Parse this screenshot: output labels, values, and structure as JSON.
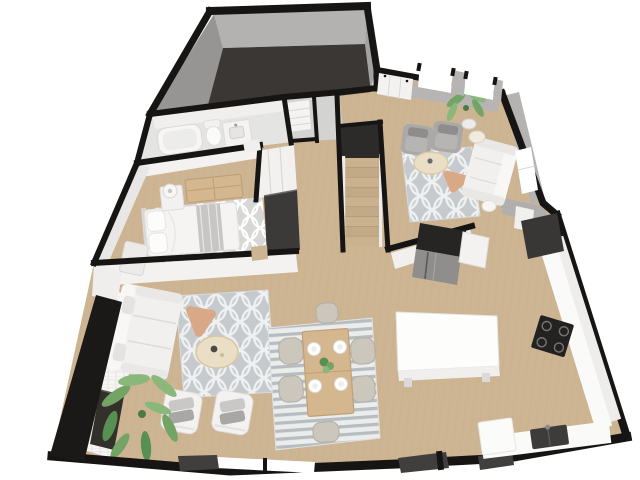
{
  "meta": {
    "title": "3D isometric floor plan render — apartment main level",
    "view": "top-down 3D dollhouse view, no visible text or UI chrome",
    "background": "#ffffff"
  },
  "palette": {
    "wall_black": "#161514",
    "wall_face_light": "#f2f1ef",
    "wall_face_gray": "#b4b3b1",
    "garage_floor": "#3a3734",
    "garage_wall_left": "#969593",
    "garage_wall_top": "#b3b2b0",
    "garage_wall_right": "#a3a2a0",
    "wood_floor": "#cdb593",
    "wood_grain": "#bda27e",
    "bath_floor": "#e4e4e2",
    "laundry_floor": "#d3d3d1",
    "stair_void": "#2c2b29",
    "rug_gray": "#c6cacd",
    "rug_motif_white": "#eef0f1",
    "rug_stripe_bg": "#ebecec",
    "rug_stripe": "#b7bcc0",
    "bedroom_rug": "#d7d7d5",
    "sofa_white": "#f1f0ee",
    "armchair_gray": "#aaa9a7",
    "table_cream": "#eadfc6",
    "table_peach": "#d9a987",
    "wood_furniture": "#d4b78e",
    "plant_green": "#74a465",
    "plant_green_light": "#8ab87b",
    "plant_green_dark": "#579050",
    "appliance_dark": "#262523",
    "stainless": "#8f8e8c",
    "counter_white": "#fafaf8",
    "cabinet_white": "#eeedeb",
    "island_white": "#fdfdfb",
    "stove_black": "#232220",
    "sink_dark": "#3d3c3a",
    "pantry_dark": "#383736",
    "threshold_dark": "#403f3d",
    "hearth_tile": "#f6f5f3",
    "console_dark": "#33302c",
    "stair_wood": "#cbb28e"
  },
  "rooms": [
    {
      "id": "garage",
      "name": "Garage",
      "floor": "dark concrete",
      "contents": []
    },
    {
      "id": "bathroom",
      "name": "Bathroom",
      "contents": [
        "bathtub",
        "toilet",
        "vanity sink"
      ]
    },
    {
      "id": "laundry",
      "name": "Laundry / Storage closet",
      "contents": [
        "white shelving unit"
      ]
    },
    {
      "id": "bedroom",
      "name": "Bedroom",
      "contents": [
        "double bed with gray throw",
        "wood dresser",
        "nightstand with lamp",
        "bench",
        "patterned area rug",
        "white closet",
        "dark wardrobe"
      ]
    },
    {
      "id": "hallway",
      "name": "Hallway",
      "contents": []
    },
    {
      "id": "staircase",
      "name": "Staircase",
      "contents": [
        "straight run of wood treads",
        "white stringers"
      ]
    },
    {
      "id": "family-room",
      "name": "Family Room",
      "contents": [
        "white sofa",
        "2 gray armchairs",
        "round cream coffee table",
        "peach accent table",
        "2 small side tables",
        "potted plant",
        "gray trellis rug"
      ]
    },
    {
      "id": "kitchen",
      "name": "Kitchen",
      "contents": [
        "dark refrigerator",
        "white cabinet run",
        "black range cooktop",
        "dark double sink",
        "white island",
        "dark pantry opening"
      ]
    },
    {
      "id": "dining-area",
      "name": "Dining Area",
      "contents": [
        "wood dining table",
        "6 chairs",
        "4 white place settings",
        "plant centerpiece",
        "gray striped rug"
      ]
    },
    {
      "id": "living-room",
      "name": "Living Room",
      "contents": [
        "white sectional sofa",
        "round cream coffee table with dark vase",
        "peach accent table",
        "2 white lounge chairs with gray pillows",
        "large potted plant",
        "gray trellis rug",
        "tiled fireplace wall",
        "dark media console"
      ]
    }
  ],
  "openings": {
    "top_wall_windows": 2,
    "east_wall_windows": 1,
    "bottom_wall_windows": 1,
    "bottom_wall_door_thresholds": 3,
    "entry_closet_doors": 1
  }
}
